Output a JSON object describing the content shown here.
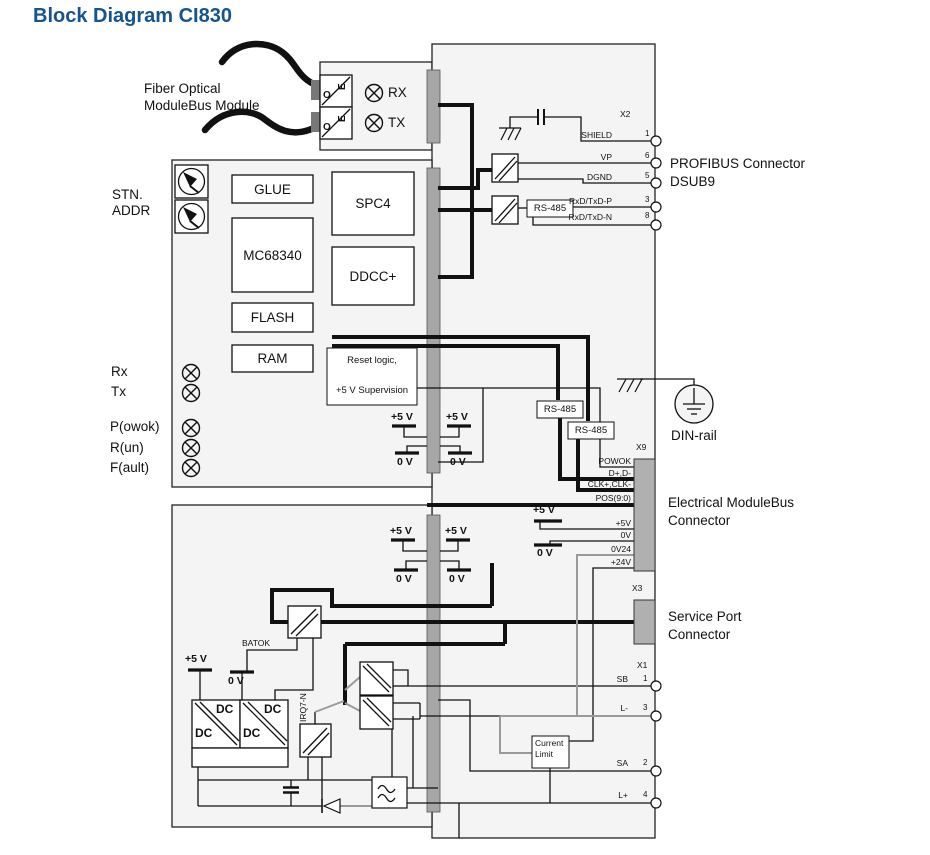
{
  "title": "Block Diagram CI830",
  "colors": {
    "title_blue": "#15548c",
    "connector_gray": "#b0b0b0",
    "bus_bar_gray": "#a6a6a6"
  },
  "fiber": {
    "line1": "Fiber Optical",
    "line2": "ModuleBus Module",
    "rx": "RX",
    "tx": "TX",
    "o": "O",
    "e": "E"
  },
  "stn": {
    "line1": "STN.",
    "line2": "ADDR"
  },
  "blocks": {
    "glue": "GLUE",
    "mc": "MC68340",
    "spc4": "SPC4",
    "ddcc": "DDCC+",
    "flash": "FLASH",
    "ram": "RAM",
    "reset1": "Reset logic,",
    "reset2": "+5 V Supervision"
  },
  "leds": {
    "rx": "Rx",
    "tx": "Tx",
    "p": "P(owok)",
    "r": "R(un)",
    "f": "F(ault)"
  },
  "profibus": {
    "x2": "X2",
    "title1": "PROFIBUS Connector",
    "title2": "DSUB9",
    "rs485": "RS-485",
    "pins": [
      {
        "name": "SHIELD",
        "num": "1"
      },
      {
        "name": "VP",
        "num": "6"
      },
      {
        "name": "DGND",
        "num": "5"
      },
      {
        "name": "RxD/TxD-P",
        "num": "3"
      },
      {
        "name": "RxD/TxD-N",
        "num": "8"
      }
    ]
  },
  "modulebus": {
    "x9": "X9",
    "title1": "Electrical ModuleBus",
    "title2": "Connector",
    "rs485a": "RS-485",
    "rs485b": "RS-485",
    "pins": [
      "POWOK",
      "D+,D-",
      "CLK+,CLK-",
      "POS(9:0)",
      "+5V",
      "0V",
      "0V24",
      "+24V"
    ]
  },
  "din": {
    "label": "DIN-rail"
  },
  "service": {
    "x3": "X3",
    "title1": "Service Port",
    "title2": "Connector"
  },
  "x1": {
    "label": "X1",
    "pins": [
      {
        "name": "SB",
        "num": "1"
      },
      {
        "name": "L-",
        "num": "3"
      },
      {
        "name": "SA",
        "num": "2"
      },
      {
        "name": "L+",
        "num": "4"
      }
    ],
    "cl1": "Current",
    "cl2": "Limit"
  },
  "power": {
    "plus5": "+5 V",
    "zero": "0 V",
    "dc": "DC",
    "batok": "BATOK",
    "irq": "IRQ7-N"
  }
}
